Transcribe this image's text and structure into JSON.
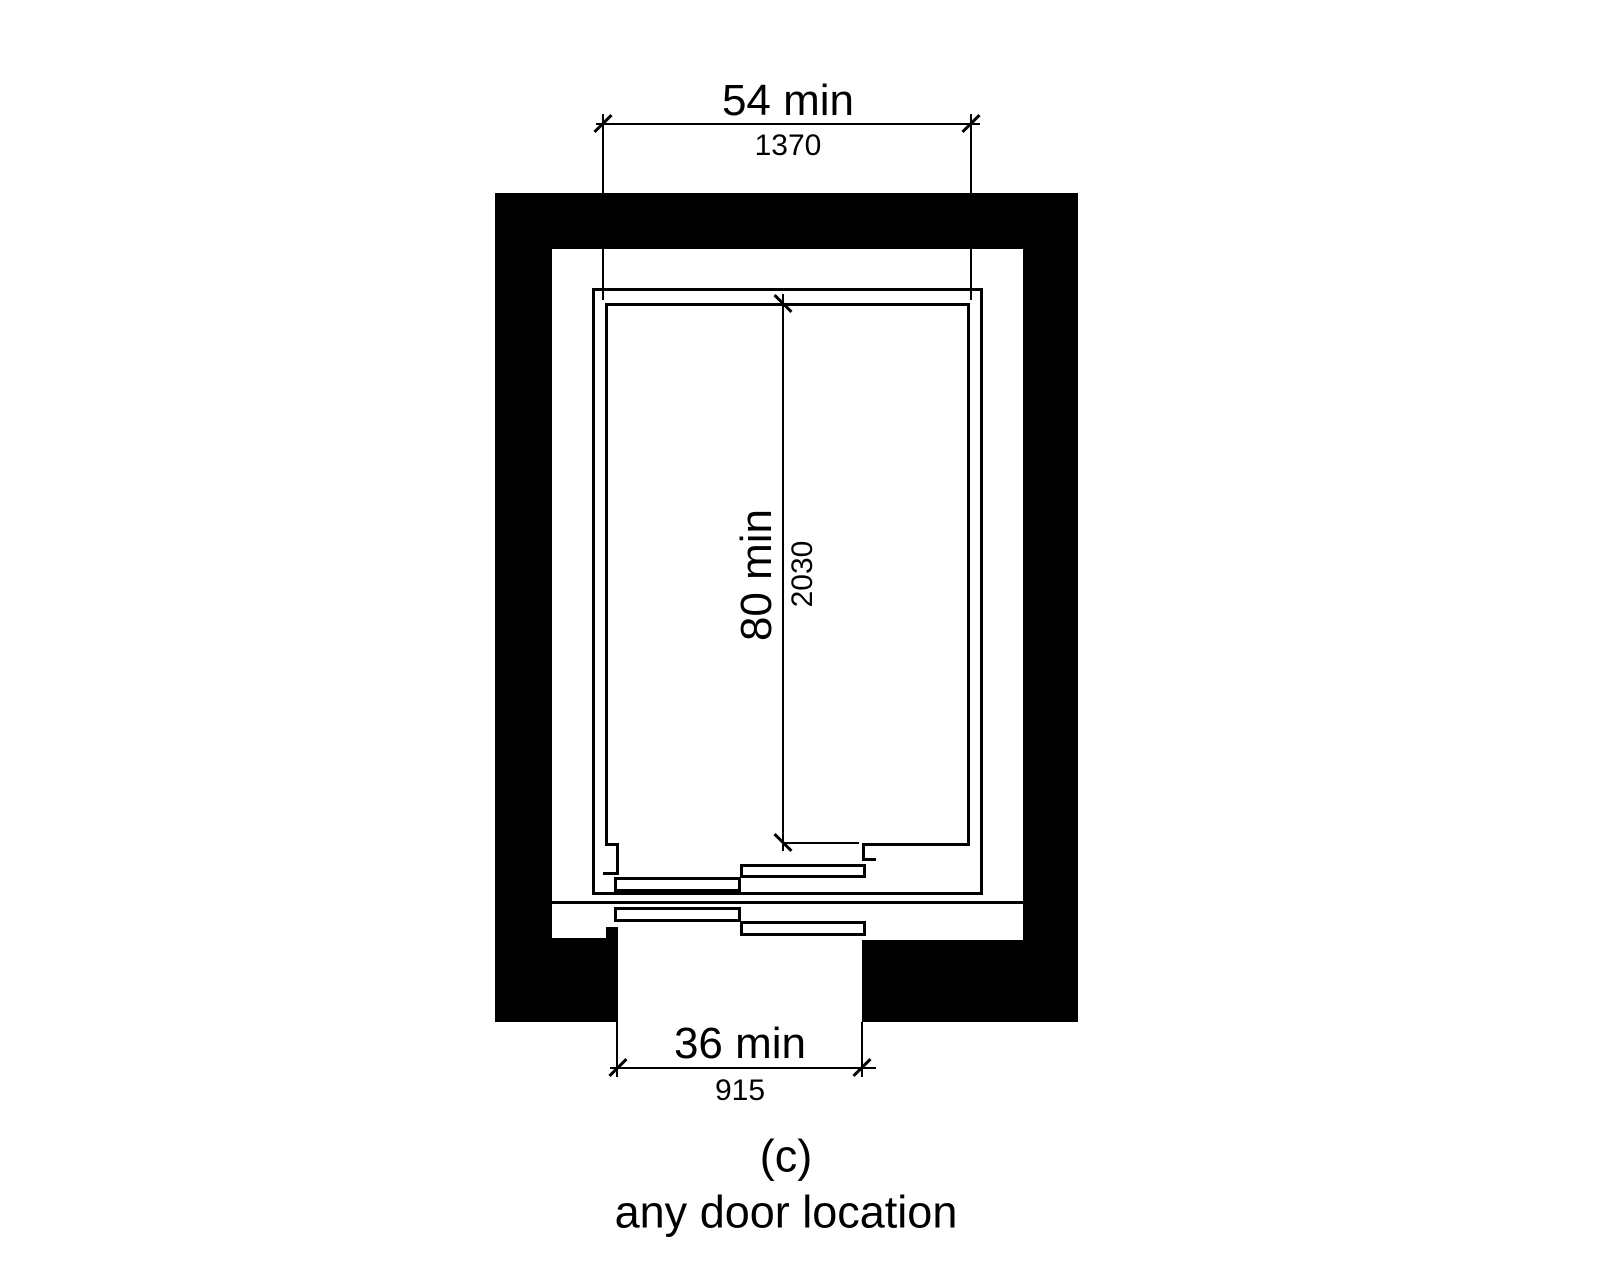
{
  "dimensions": {
    "car_width": {
      "imperial": "54 min",
      "metric": "1370"
    },
    "car_depth": {
      "imperial": "80 min",
      "metric": "2030"
    },
    "door_clear": {
      "imperial": "36 min",
      "metric": "915"
    }
  },
  "caption": {
    "letter": "(c)",
    "text": "any door location"
  },
  "colors": {
    "ink": "#000000",
    "paper": "#ffffff",
    "wall_fill": "#000000"
  }
}
